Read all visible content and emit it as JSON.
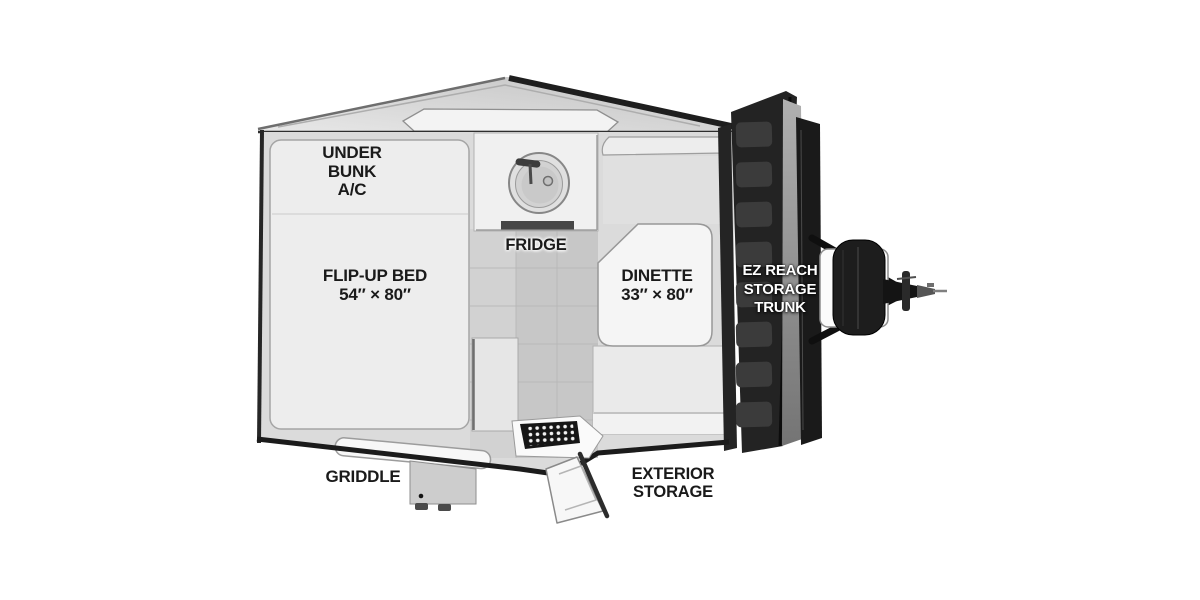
{
  "floorplan": {
    "areas": {
      "under_bunk_ac": {
        "lines": [
          "UNDER",
          "BUNK",
          "A/C"
        ]
      },
      "flip_up_bed": {
        "name": "FLIP-UP BED",
        "dimensions": "54″ × 80″"
      },
      "fridge": {
        "name": "FRIDGE"
      },
      "dinette": {
        "name": "DINETTE",
        "dimensions": "33″ × 80″"
      },
      "ez_reach_storage_trunk": {
        "lines": [
          "EZ REACH",
          "STORAGE",
          "TRUNK"
        ]
      },
      "griddle": {
        "name": "GRIDDLE"
      },
      "exterior_storage": {
        "lines": [
          "EXTERIOR",
          "STORAGE"
        ]
      }
    },
    "colors": {
      "background": "#ffffff",
      "label_text": "#1a1a1a",
      "trunk_label_text": "#ffffff",
      "body_dark": "#1f1f1f",
      "interior_grey": "#dbdbdb",
      "floor_grey": "#c7c7c7",
      "bed_grey": "#ededed",
      "trunk_dark": "#232323"
    }
  }
}
